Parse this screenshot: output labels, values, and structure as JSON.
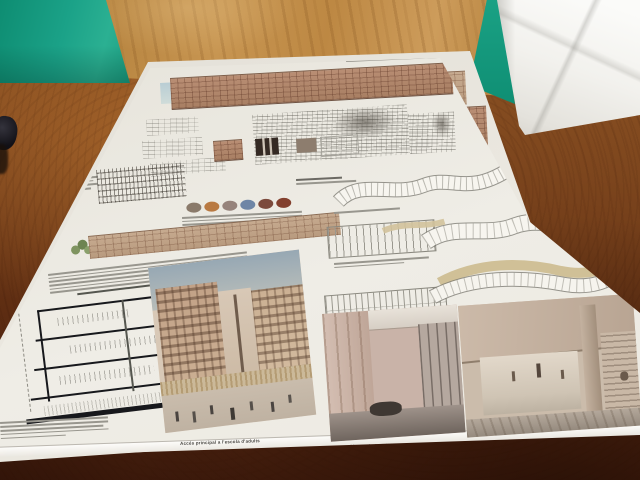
{
  "scene": {
    "description": "Photograph: two architectural competition presentation boards lying flat on a reddish-brown wooden desk; teal-green wall and light oak wood panel behind, white paper bag at the right.",
    "colors": {
      "green_wall": "#17a085",
      "wood_panel": "#c3904e",
      "desk_wood": "#7c4218",
      "board_paper": "#edeae2",
      "paper_bag": "#f3f2ee",
      "brick_elevation": "#b08468"
    }
  },
  "board": {
    "captions": {
      "exterior_render": "Accés principal a l'escola d'adults",
      "interior_render_1": "Planta altell en l'escola d'adults",
      "interior_render_2": "Accés principal habitatges"
    },
    "material_swatches": [
      "#8a7a6a",
      "#b97a42",
      "#96837b",
      "#6f86a6",
      "#7c4a3c",
      "#83402e"
    ]
  }
}
